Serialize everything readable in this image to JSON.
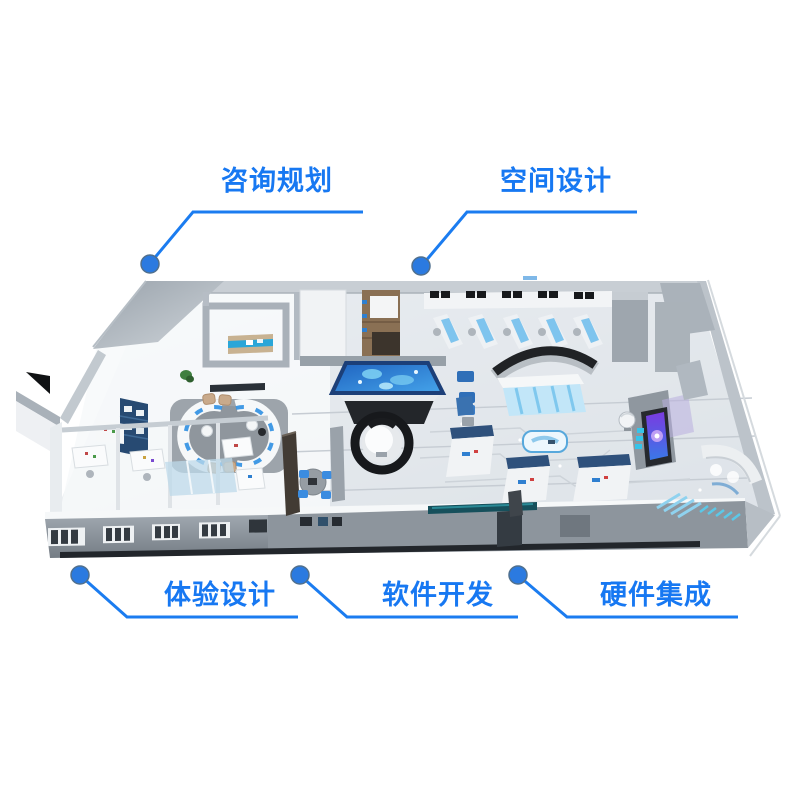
{
  "colors": {
    "accent": "#1778f2",
    "line": "#1b7cf0",
    "dot_fill": "#2b7ae0",
    "dot_edge": "#50708e",
    "sand_table_blue": "#2f8fe0",
    "screen_purple": "#7a3be0",
    "kiosk_header_navy": "#2f517c"
  },
  "callouts": [
    {
      "id": "consulting-planning",
      "label": "咨询规划",
      "position": "top-left"
    },
    {
      "id": "space-design",
      "label": "空间设计",
      "position": "top-right"
    },
    {
      "id": "experience-design",
      "label": "体验设计",
      "position": "bottom-left"
    },
    {
      "id": "software-development",
      "label": "软件开发",
      "position": "bottom-center"
    },
    {
      "id": "hardware-integration",
      "label": "硬件集成",
      "position": "bottom-right"
    }
  ],
  "floorplan": {
    "alt": "3D isometric render of a digital exhibition hall interior",
    "features": [
      "reception-lounge",
      "meeting-room",
      "offices",
      "interactive-sand-table",
      "dome-theater",
      "workstation-row",
      "exhibit-kiosks",
      "purple-screen-display",
      "curved-exhibit",
      "front-wall-windows"
    ]
  }
}
